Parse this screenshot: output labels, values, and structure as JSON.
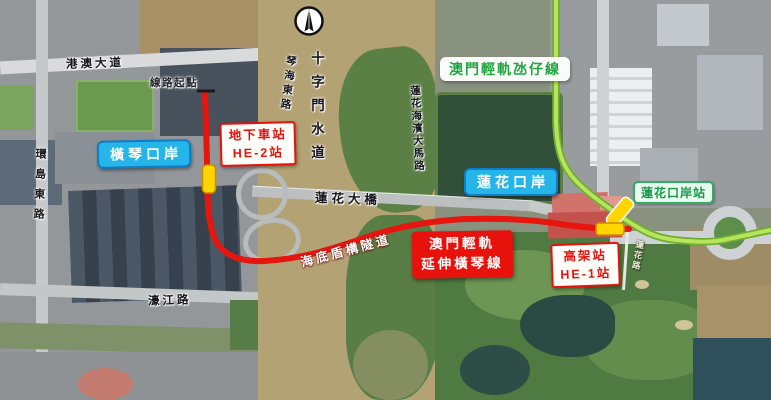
{
  "map": {
    "roads": {
      "gangao": "港澳大道",
      "huandao_east": "環島東路",
      "qinhai_east": "琴海東路",
      "shizimen_waterway": "十字門水道",
      "lianhua_seaside": "蓮花海濱大馬路",
      "haojiang": "濠江路",
      "lianhua_small": "蓮花路"
    },
    "landmarks": {
      "lotus_bridge": "蓮花大橋",
      "line_start": "線路起點"
    },
    "ports": {
      "hengqin": "橫琴口岸",
      "lotus": "蓮花口岸"
    },
    "transit": {
      "taipa_line_label": "澳門輕軌氹仔線",
      "extension_line1": "澳門輕軌",
      "extension_line2": "延伸橫琴線",
      "tunnel_label": "海底盾構隧道",
      "he2_line1": "地下車站",
      "he2_line2": "HE-2站",
      "he1_line1": "高架站",
      "he1_line2": "HE-1站",
      "lotus_port_station": "蓮花口岸站"
    },
    "colors": {
      "extension_line": "#e6150e",
      "taipa_line_core": "#b6e45c",
      "taipa_line_edge": "#6fae2e",
      "station_marker": "#ffd400",
      "marker_border": "#cf8a00"
    }
  }
}
